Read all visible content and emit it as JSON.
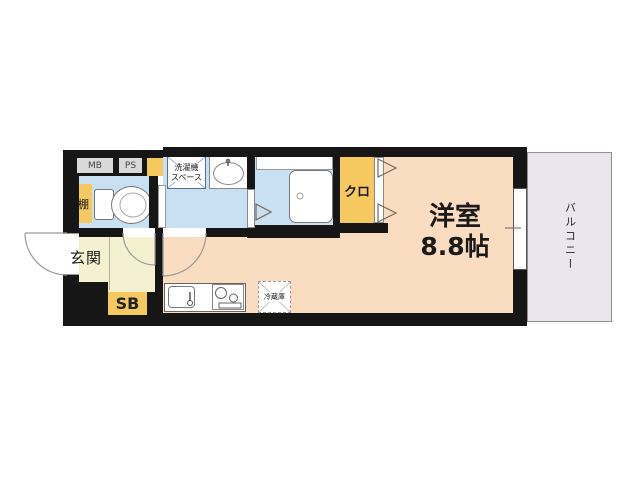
{
  "plan": {
    "wall_boxes": {
      "meter_box": "MB",
      "pipe_space": "PS"
    },
    "rooms": {
      "main_room": {
        "name": "洋室",
        "size": "8.8帖"
      },
      "balcony": {
        "label": "バルコニー"
      },
      "entrance": {
        "label": "玄関",
        "shoe_box": "SB"
      },
      "closet": {
        "label": "クロ"
      },
      "toilet": {
        "shelf": "棚"
      },
      "washroom": {
        "washing_machine_line1": "洗濯機",
        "washing_machine_line2": "スペース"
      },
      "kitchen": {
        "refrigerator": "冷蔵庫"
      }
    },
    "colors": {
      "wall": "#161616",
      "main_room_floor": "#FADCC1",
      "wet_area_floor": "#C9DFF2",
      "entrance_floor": "#F5F1D0",
      "accent_yellow": "#F5C95F",
      "balcony_floor": "#E9E7ED",
      "label_box": "#D9D9D9"
    }
  }
}
